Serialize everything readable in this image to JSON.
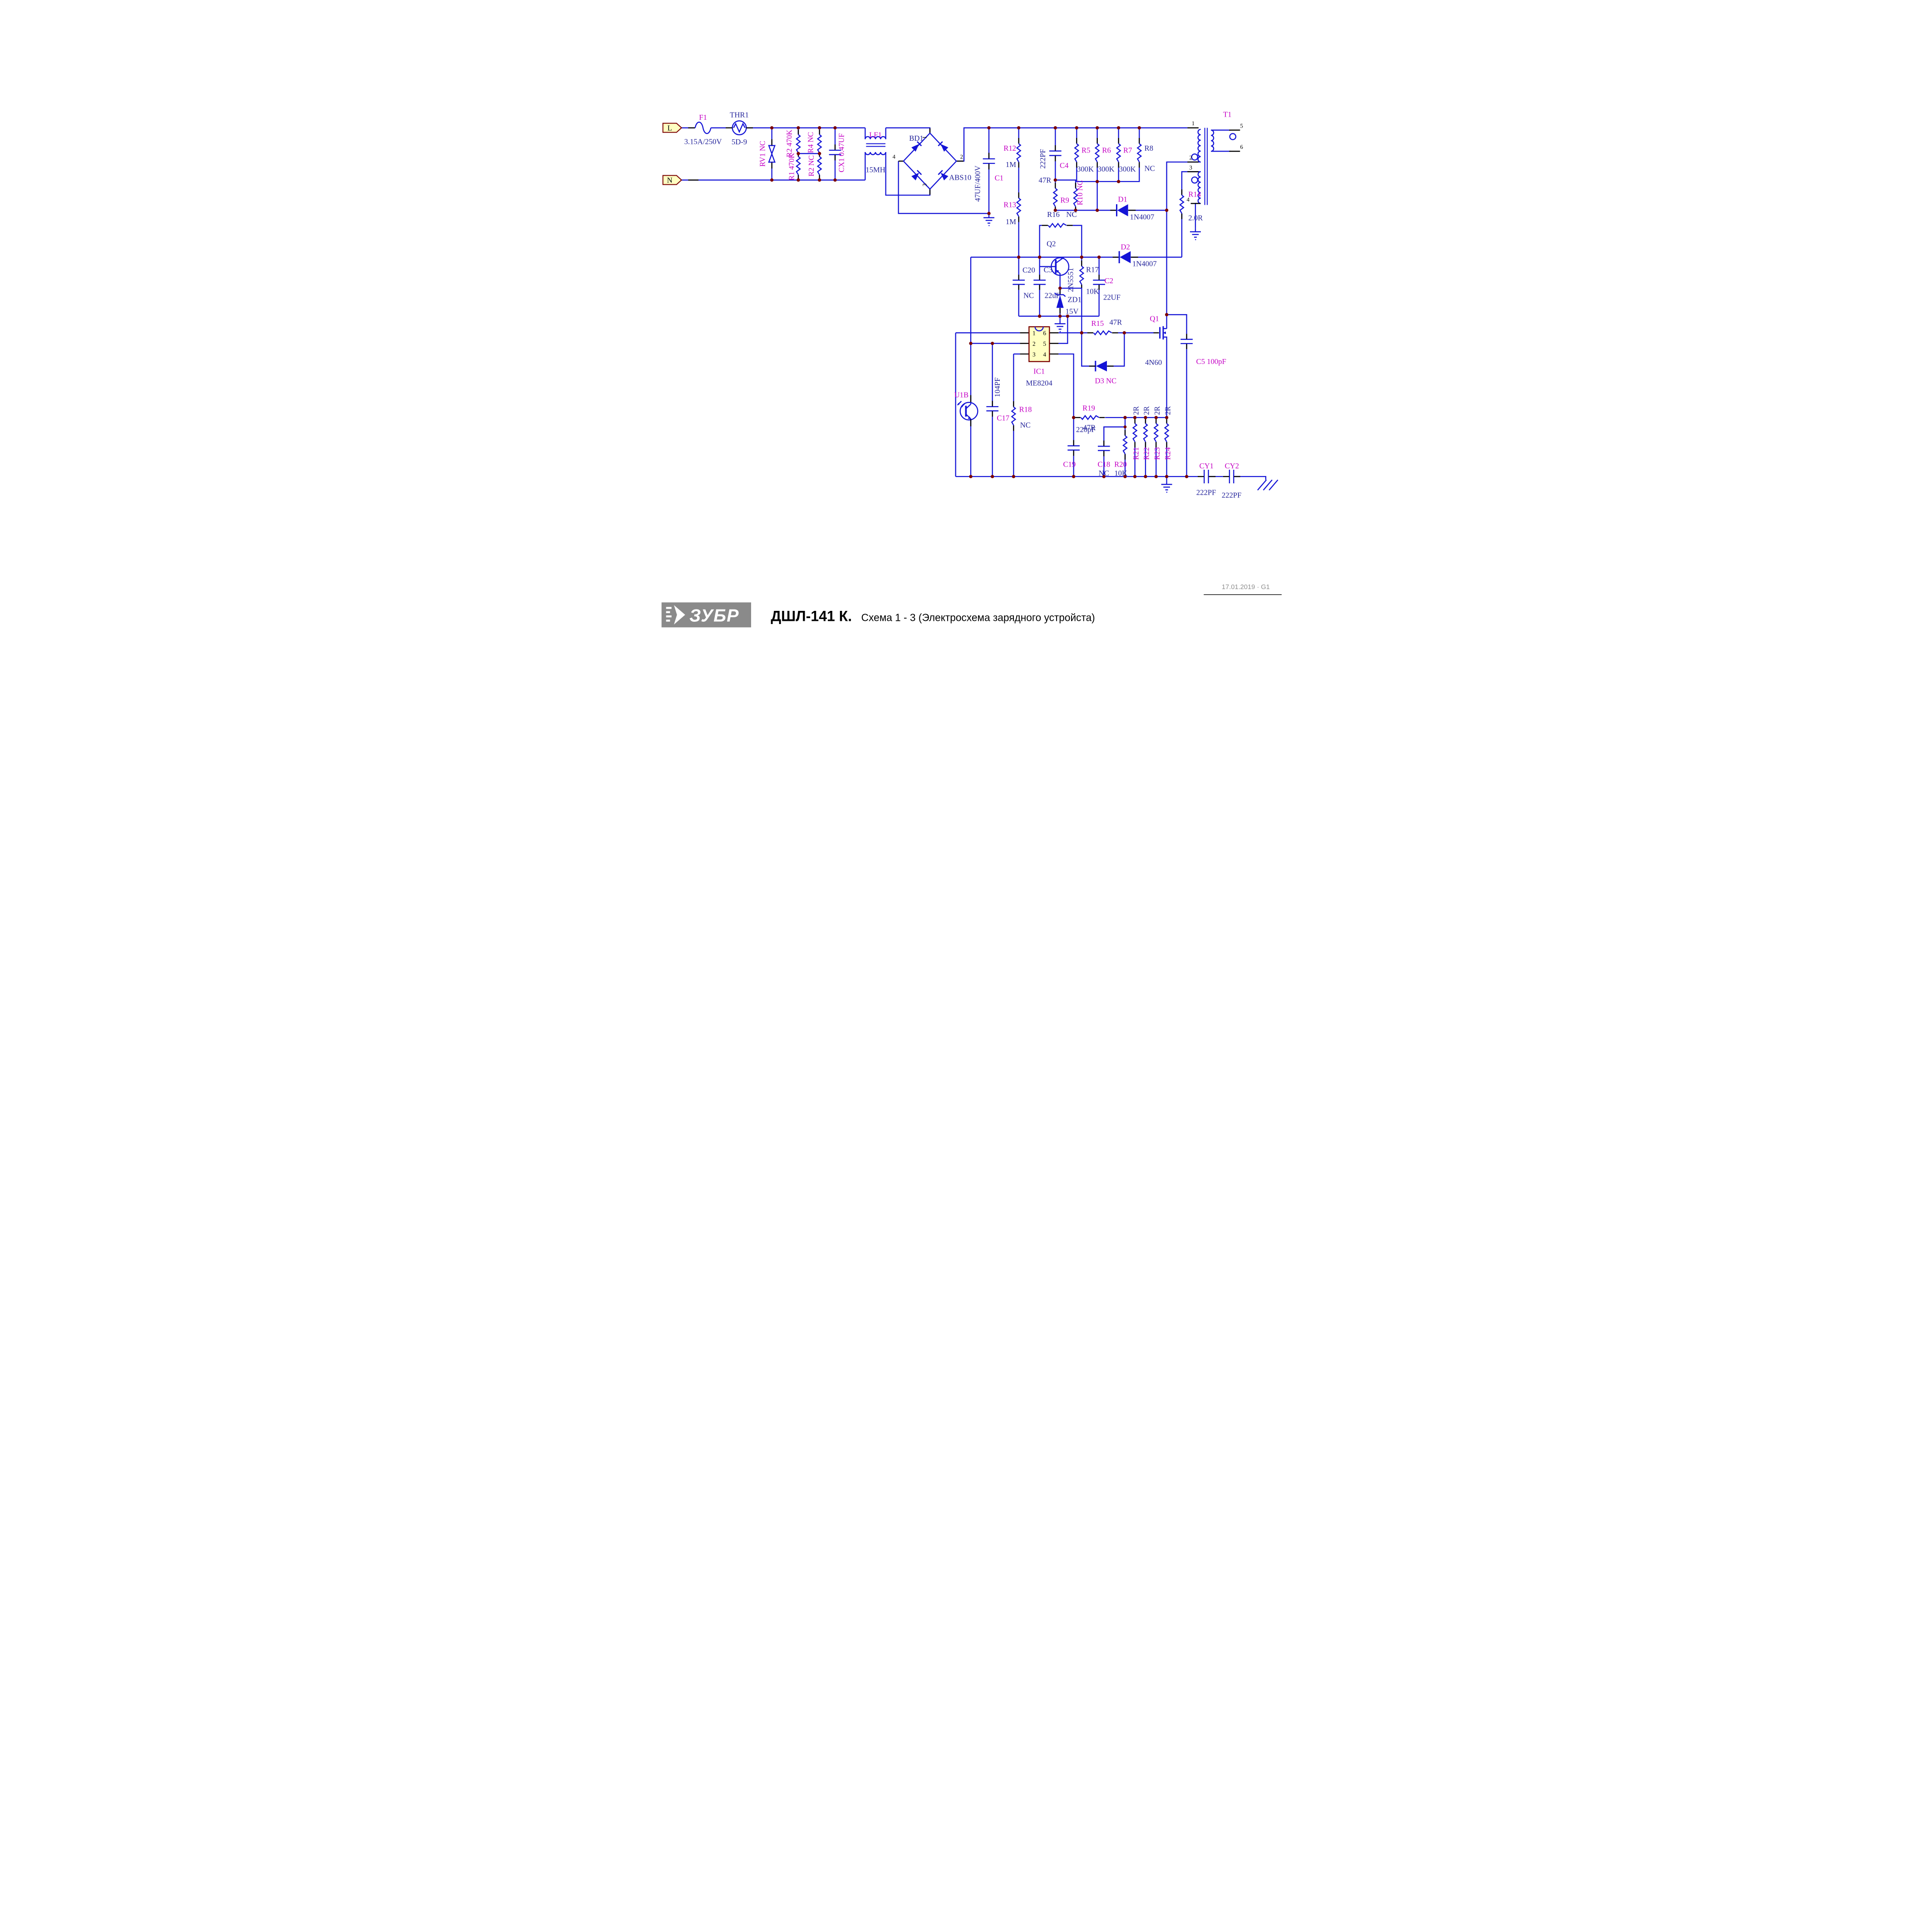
{
  "colors": {
    "wire_blue": "#1414d6",
    "designator_pink": "#c400c4",
    "value_navy": "#24249b",
    "junction_maroon": "#7a0101",
    "terminal_yellow": "#ffffc2",
    "ic_yellow": "#ffffc2",
    "border_maroon": "#7a0101",
    "logo_gray": "#8a8a8a"
  },
  "terminals": {
    "l": "L",
    "n": "N"
  },
  "c": {
    "f1": {
      "ref": "F1",
      "val": "3.15A/250V"
    },
    "thr1": {
      "ref": "THR1",
      "val": "5D-9"
    },
    "rv1": {
      "ref": "RV1 NC"
    },
    "r2a": {
      "ref": "R2 470K"
    },
    "r1": {
      "ref": "R1 470K"
    },
    "r4": {
      "ref": "R4 NC"
    },
    "r2b": {
      "ref": "R2 NC"
    },
    "cx1": {
      "ref": "CX1 0.47UF"
    },
    "lf1": {
      "ref": "LF1",
      "val": "15MH"
    },
    "bd1": {
      "ref": "BD1",
      "val": "ABS10",
      "pins": [
        "1",
        "2",
        "3",
        "4"
      ]
    },
    "c1": {
      "ref": "C1",
      "val": "47UF/400V"
    },
    "r12": {
      "ref": "R12",
      "val": "1M"
    },
    "r13": {
      "ref": "R13",
      "val": "1M"
    },
    "c4": {
      "ref": "C4",
      "val": "222PF"
    },
    "r5": {
      "ref": "R5",
      "val": "300K"
    },
    "r6": {
      "ref": "R6",
      "val": "300K"
    },
    "r7": {
      "ref": "R7",
      "val": "300K"
    },
    "r8": {
      "ref": "R8",
      "val": "NC"
    },
    "r9": {
      "ref": "R9",
      "val": "47R"
    },
    "r10": {
      "ref": "R10 NC"
    },
    "d1": {
      "ref": "D1",
      "val": "1N4007"
    },
    "r14": {
      "ref": "R14",
      "val": "2.0R"
    },
    "t1": {
      "ref": "T1",
      "pins": [
        "1",
        "2",
        "3",
        "4",
        "5",
        "6"
      ]
    },
    "d2": {
      "ref": "D2",
      "val": "1N4007"
    },
    "r16": {
      "ref": "R16",
      "val": "NC"
    },
    "q2": {
      "ref": "Q2",
      "val": "2N5551"
    },
    "c20": {
      "ref": "C20",
      "val": "NC"
    },
    "c3": {
      "ref": "C3",
      "val": "22uF"
    },
    "r17": {
      "ref": "R17",
      "val": "10K"
    },
    "c2": {
      "ref": "C2",
      "val": "22UF"
    },
    "zd1": {
      "ref": "ZD1",
      "val": "15V"
    },
    "ic1": {
      "ref": "IC1",
      "val": "ME8204",
      "pins": [
        "1",
        "2",
        "3",
        "4",
        "5",
        "6"
      ]
    },
    "r15": {
      "ref": "R15",
      "val": "47R"
    },
    "d3": {
      "ref": "D3 NC"
    },
    "q1": {
      "ref": "Q1",
      "val": "4N60"
    },
    "c5": {
      "ref": "C5 100pF"
    },
    "r19": {
      "ref": "R19",
      "val": "47R"
    },
    "u1b": {
      "ref": "U1B"
    },
    "c17": {
      "ref": "C17",
      "val": "104PF"
    },
    "r18": {
      "ref": "R18",
      "val": "NC"
    },
    "c19": {
      "ref": "C19",
      "val": "220pF"
    },
    "c18": {
      "ref": "C18",
      "val": "NC"
    },
    "r20": {
      "ref": "R20",
      "val": "10K"
    },
    "r21": {
      "ref": "R21",
      "val": "2R"
    },
    "r22": {
      "ref": "R22",
      "val": "2R"
    },
    "r23": {
      "ref": "R23",
      "val": "2R"
    },
    "r24": {
      "ref": "R24",
      "val": "2R"
    },
    "cy1": {
      "ref": "CY1",
      "val": "222PF"
    },
    "cy2": {
      "ref": "CY2",
      "val": "222PF"
    }
  },
  "footer": {
    "logo": "ЗУБР",
    "model": "ДШЛ-141 К.",
    "subtitle": "Схема 1 - 3 (Электросхема зарядного устройста)",
    "revision": "17.01.2019 · G1"
  }
}
